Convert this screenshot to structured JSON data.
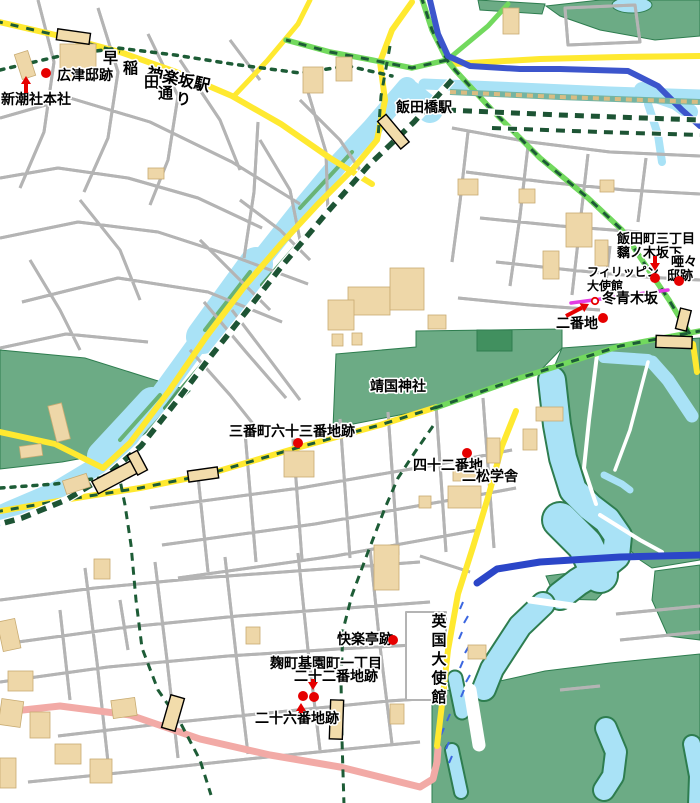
{
  "map": {
    "colors": {
      "marker_red": "#e60000",
      "route_green": "#1d5c36",
      "road_yellow": "#ffe930",
      "road_pink": "#f2aaa6",
      "expressway_blue": "#3c55cc",
      "water_blue": "#a9e2f6",
      "park_green": "#6cab85",
      "slope_magenta": "#e23ce2",
      "building_tan": "#eed7a8"
    },
    "labels": [
      {
        "id": "label-kagurazaka-station",
        "text": "神楽坂駅",
        "x": 146,
        "y": 78,
        "size": 16,
        "rotate": 12
      },
      {
        "id": "label-hirotsu-tei-ato",
        "text": "広津邸跡",
        "x": 57,
        "y": 80,
        "size": 14
      },
      {
        "id": "label-shinchosha-honsha",
        "text": "新潮社本社",
        "x": 1,
        "y": 104,
        "size": 14
      },
      {
        "id": "label-waseda-dori",
        "mode": "scatter",
        "size": 15,
        "chars": [
          {
            "t": "早",
            "x": 103,
            "y": 63
          },
          {
            "t": "稲",
            "x": 123,
            "y": 73
          },
          {
            "t": "田",
            "x": 144,
            "y": 87
          },
          {
            "t": "通",
            "x": 158,
            "y": 98
          },
          {
            "t": "り",
            "x": 176,
            "y": 104
          }
        ]
      },
      {
        "id": "label-iidabashi-station",
        "text": "飯田橋駅",
        "x": 396,
        "y": 112,
        "size": 14
      },
      {
        "id": "label-iidamachi-3chome",
        "text": "飯田町三丁目",
        "x": 617,
        "y": 243,
        "size": 13
      },
      {
        "id": "label-mochinoki-sakashita",
        "text": "黐ノ木坂下",
        "x": 617,
        "y": 257,
        "size": 13
      },
      {
        "id": "label-aa-tei-ato",
        "mode": "scatter",
        "size": 13,
        "chars": [
          {
            "t": "唖々",
            "x": 671,
            "y": 266
          },
          {
            "t": "邸跡",
            "x": 667,
            "y": 280
          }
        ]
      },
      {
        "id": "label-philippine-embassy",
        "mode": "scatter",
        "size": 12,
        "chars": [
          {
            "t": "フィリッピン",
            "x": 587,
            "y": 276
          },
          {
            "t": "大使館",
            "x": 587,
            "y": 290
          }
        ]
      },
      {
        "id": "label-mochinoki-zaka",
        "text": "冬青木坂",
        "x": 602,
        "y": 303,
        "size": 14
      },
      {
        "id": "label-nibanchi",
        "text": "二番地",
        "x": 556,
        "y": 328,
        "size": 14
      },
      {
        "id": "label-yasukuni-jinja",
        "text": "靖国神社",
        "x": 370,
        "y": 391,
        "size": 14
      },
      {
        "id": "label-sanbancho-63banchi-ato",
        "text": "三番町六十三番地跡",
        "x": 229,
        "y": 436,
        "size": 14
      },
      {
        "id": "label-42banchi",
        "text": "四十二番地",
        "x": 413,
        "y": 470,
        "size": 14
      },
      {
        "id": "label-nisho-gakusha",
        "text": "二松学舎",
        "x": 462,
        "y": 481,
        "size": 14
      },
      {
        "id": "label-uk-embassy",
        "mode": "vertical",
        "text": "英国大使館",
        "x": 439,
        "y": 626,
        "size": 15,
        "spacing": 19
      },
      {
        "id": "label-kairakutei-ato",
        "text": "快楽亭跡",
        "x": 337,
        "y": 644,
        "size": 14
      },
      {
        "id": "label-kojimachi-kiencho-1chome",
        "text": "麹町基園町一丁目",
        "x": 270,
        "y": 668,
        "size": 14
      },
      {
        "id": "label-22banchi-ato",
        "text": "二十二番地跡",
        "x": 294,
        "y": 681,
        "size": 14
      },
      {
        "id": "label-26banchi-ato",
        "text": "二十六番地跡",
        "x": 255,
        "y": 723,
        "size": 14
      }
    ],
    "markers": {
      "dots": [
        {
          "id": "dot-hirotsu",
          "x": 46,
          "y": 73
        },
        {
          "id": "dot-mochinoki-sakashita",
          "x": 655,
          "y": 278
        },
        {
          "id": "dot-aa-tei",
          "x": 679,
          "y": 281
        },
        {
          "id": "dot-nibanchi-area",
          "x": 603,
          "y": 318
        },
        {
          "id": "dot-sanbancho-63",
          "x": 298,
          "y": 443
        },
        {
          "id": "dot-42banchi",
          "x": 467,
          "y": 453
        },
        {
          "id": "dot-kairakutei",
          "x": 393,
          "y": 640
        },
        {
          "id": "dot-26banchi",
          "x": 303,
          "y": 696
        },
        {
          "id": "dot-22banchi",
          "x": 314,
          "y": 697
        }
      ],
      "open_circles": [
        {
          "id": "circle-nibanchi",
          "x": 595,
          "y": 301
        }
      ],
      "arrows": [
        {
          "id": "arrow-shinchosha",
          "x1": 26,
          "y1": 93,
          "x2": 26,
          "y2": 76
        },
        {
          "id": "arrow-mochinoki-sakashita",
          "x1": 655,
          "y1": 256,
          "x2": 655,
          "y2": 271
        },
        {
          "id": "arrow-nibanchi",
          "x1": 566,
          "y1": 316,
          "x2": 589,
          "y2": 304
        },
        {
          "id": "arrow-22banchi",
          "x1": 313,
          "y1": 679,
          "x2": 313,
          "y2": 690
        },
        {
          "id": "arrow-26banchi",
          "x1": 301,
          "y1": 713,
          "x2": 301,
          "y2": 703
        }
      ]
    }
  }
}
